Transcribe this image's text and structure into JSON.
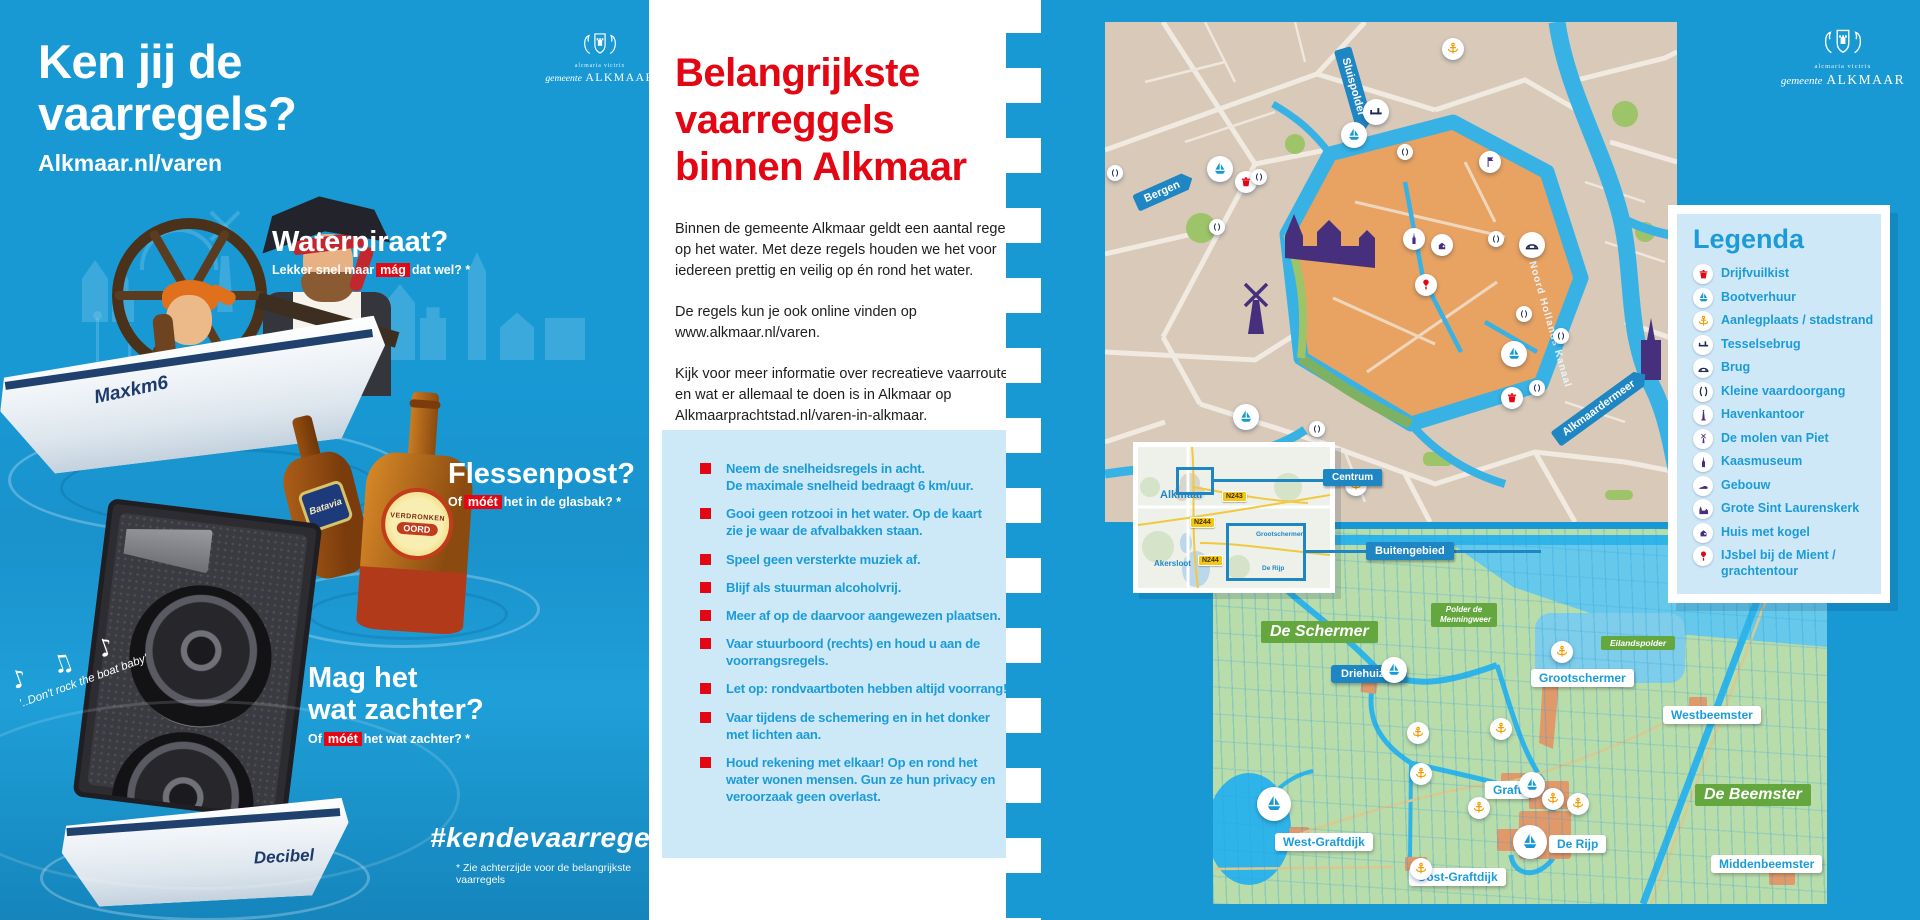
{
  "colors": {
    "panel-blue": "#1899d4",
    "accent-red": "#e30613",
    "text-blue": "#1b9cd8",
    "box-blue": "#cde9f7",
    "pill-blue": "#1f86c4",
    "label-green": "#64a73e",
    "map-tan": "#d8c9b8",
    "map-orange": "#e8a262",
    "water-blue": "#2fb4e9",
    "purple": "#46307e",
    "anchor-orange": "#f49b00"
  },
  "brand": {
    "motto": "alcmaria victrix",
    "org": "gemeente",
    "name": "ALKMAAR"
  },
  "left": {
    "title1": "Ken jij de",
    "title2": "vaarregels?",
    "subtitle": "Alkmaar.nl/varen",
    "boat1": "Maxkm6",
    "boat2": "Decibel",
    "bottle1": "Batavia",
    "bottle2a": "VERDRONKEN",
    "bottle2b": "OORD",
    "music_notes": "♪ ♫ ♪",
    "music_text": "'..Don't rock the boat baby'",
    "q1": {
      "title": "Waterpiraat?",
      "pre": "Lekker snel maar",
      "hl": "mág",
      "post": "dat wel? *"
    },
    "q2": {
      "title": "Flessenpost?",
      "pre": "Of",
      "hl": "móét",
      "post": "het in de glasbak? *"
    },
    "q3": {
      "title1": "Mag het",
      "title2": "wat zachter?",
      "pre": "Of",
      "hl": "móét",
      "post": "het wat zachter? *"
    },
    "hashtag": "#kendevaarregels",
    "footnote": "* Zie achterzijde voor de belangrijkste vaarregels"
  },
  "mid": {
    "heading_lines": [
      "Belangrijkste",
      "vaarreggels",
      "binnen Alkmaar"
    ],
    "paragraphs": [
      "Binnen de gemeente Alkmaar geldt een aantal regels\nop het water. Met deze regels houden we het voor\niedereen prettig en veilig op én rond het water.",
      "De regels kun je ook online vinden op\nwww.alkmaar.nl/varen.",
      "Kijk voor meer informatie over recreatieve vaarroutes\nen wat er allemaal te doen is in Alkmaar op\nAlkmaarprachtstad.nl/varen-in-alkmaar."
    ],
    "rules": [
      "Neem de snelheidsregels in acht.\nDe maximale snelheid bedraagt 6 km/uur.",
      "Gooi geen rotzooi in het water. Op de kaart\nzie je waar de afvalbakken staan.",
      "Speel geen versterkte muziek af.",
      "Blijf als stuurman alcoholvrij.",
      "Meer af op de daarvoor aangewezen plaatsen.",
      "Vaar stuurboord (rechts) en houd u aan de\nvoorrangsregels.",
      "Let op: rondvaartboten hebben altijd voorrang!",
      "Vaar tijdens de schemering en in het donker\nmet lichten aan.",
      "Houd rekening met elkaar! Op en rond het\nwater wonen mensen. Gun ze hun privacy en\nveroorzaak geen overlast."
    ]
  },
  "right": {
    "city": {
      "bergen": "Bergen",
      "sluispolder": "Sluispolder",
      "kanaal": "Noord Hollands Kanaal",
      "meer": "Alkmaardermeer"
    },
    "legend": {
      "title": "Legenda",
      "items": [
        {
          "icon": "floating-waste-bin-icon",
          "label": "Drijfvuilkist"
        },
        {
          "icon": "boat-rental-icon",
          "label": "Bootverhuur"
        },
        {
          "icon": "mooring-anchor-icon",
          "label": "Aanlegplaats / stadstrand"
        },
        {
          "icon": "tessel-bridge-icon",
          "label": "Tesselsebrug"
        },
        {
          "icon": "bridge-icon",
          "label": "Brug"
        },
        {
          "icon": "small-passage-icon",
          "label": "Kleine vaardoorgang"
        },
        {
          "icon": "harbor-office-icon",
          "label": "Havenkantoor"
        },
        {
          "icon": "windmill-icon",
          "label": "De molen van Piet"
        },
        {
          "icon": "cheese-museum-icon",
          "label": "Kaasmuseum"
        },
        {
          "icon": "building-icon",
          "label": "Gebouw"
        },
        {
          "icon": "church-icon",
          "label": "Grote Sint Laurenskerk"
        },
        {
          "icon": "cannonball-house-icon",
          "label": "Huis met kogel"
        },
        {
          "icon": "icecream-canal-tour-icon",
          "label": "IJsbel bij de Mient / grachtentour"
        }
      ]
    },
    "inset": {
      "alkmaar": "Alkmaar",
      "centrum": "Centrum",
      "akersloot": "Akersloot",
      "grootschermer": "Grootschermer",
      "derijp": "De Rijp",
      "n243": "N243",
      "n244": "N244"
    },
    "region": {
      "buitengebied": "Buitengebied",
      "schermer": "De Schermer",
      "menningweer": "Polder de Menningweer",
      "eilandspolder": "Eilandspolder",
      "beemster": "De Beemster",
      "driehuizen": "Driehuizen",
      "grootschermer": "Grootschermer",
      "westbeemster": "Westbeemster",
      "westgraftdijk": "West-Graftdijk",
      "oostgraftdijk": "Oost-Graftdijk",
      "graft": "Graft",
      "derijp": "De Rijp",
      "middenbeemster": "Middenbeemster"
    }
  }
}
